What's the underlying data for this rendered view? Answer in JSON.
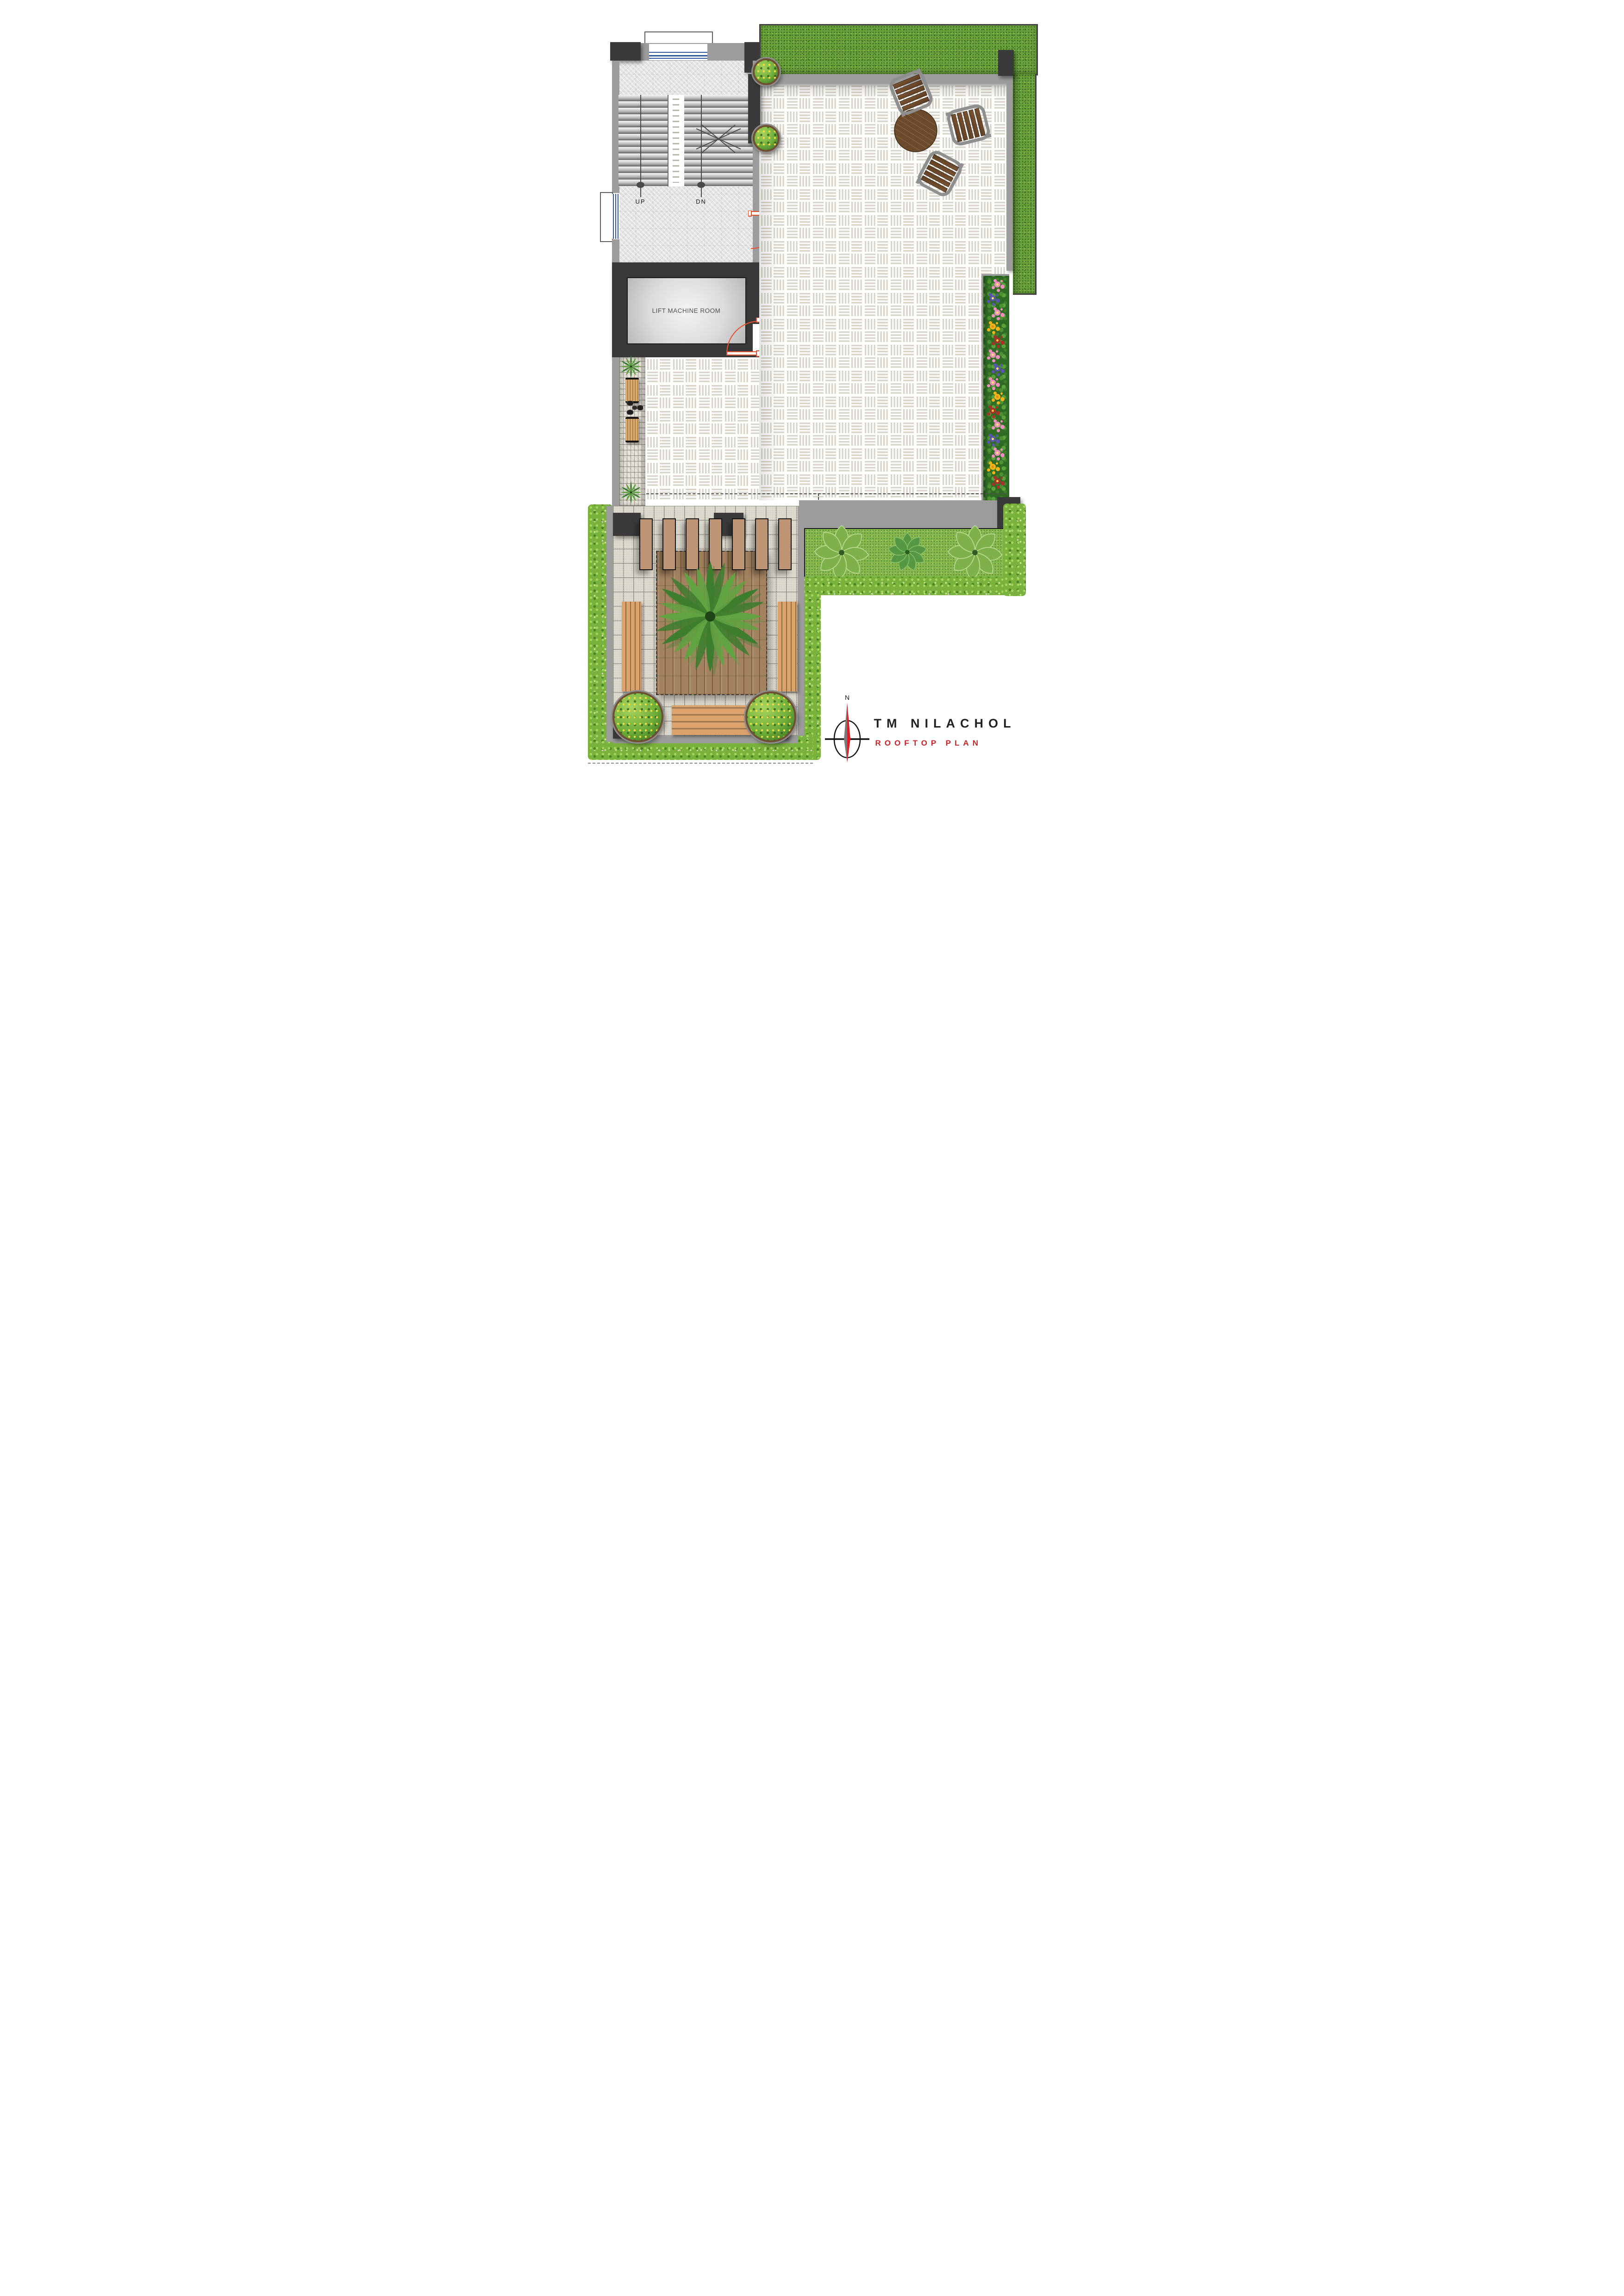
{
  "labels": {
    "stair_up": "UP",
    "stair_down": "DN",
    "lift_machine_room": "LIFT MACHINE ROOM"
  },
  "title_block": {
    "project_name": "TM NILACHOL",
    "drawing_title": "ROOFTOP PLAN",
    "north_label": "N",
    "project_name_color": "#231f20",
    "drawing_title_color": "#c8232b"
  },
  "palette": {
    "dark_wall": "#3a3a3a",
    "gray_wall": "#9c9c9c",
    "grass": "#69a03c",
    "hedge": "#7ab23e",
    "tile_dash": "#d8d4c9",
    "deck_wood": "#a2825f",
    "bench_wood": "#dca26c",
    "bench_leg_teal": "#14506b",
    "pergola_slat": "#bd9474",
    "door_swing": "#e8512d",
    "compass_red": "#d92027",
    "flower_pink": "#ef8fc0",
    "flower_purple": "#5a55ae",
    "flower_yellow": "#f4b414",
    "flower_red": "#a8322a"
  },
  "flower_bed": {
    "cluster_colors": [
      "pink",
      "purple",
      "pink",
      "yellow",
      "red",
      "pink",
      "purple",
      "pink",
      "yellow",
      "red",
      "pink",
      "purple",
      "pink",
      "yellow",
      "red"
    ]
  },
  "counts": {
    "pergola_slats": 7,
    "terrace_chairs": 3,
    "walkway_benches": 2,
    "courtyard_side_benches": 2,
    "courtyard_bottom_benches": 1,
    "walkway_stool_seats": 4,
    "courtyard_round_planters": 2,
    "terrace_shrub_pots": 2,
    "stair_flights": 2
  }
}
